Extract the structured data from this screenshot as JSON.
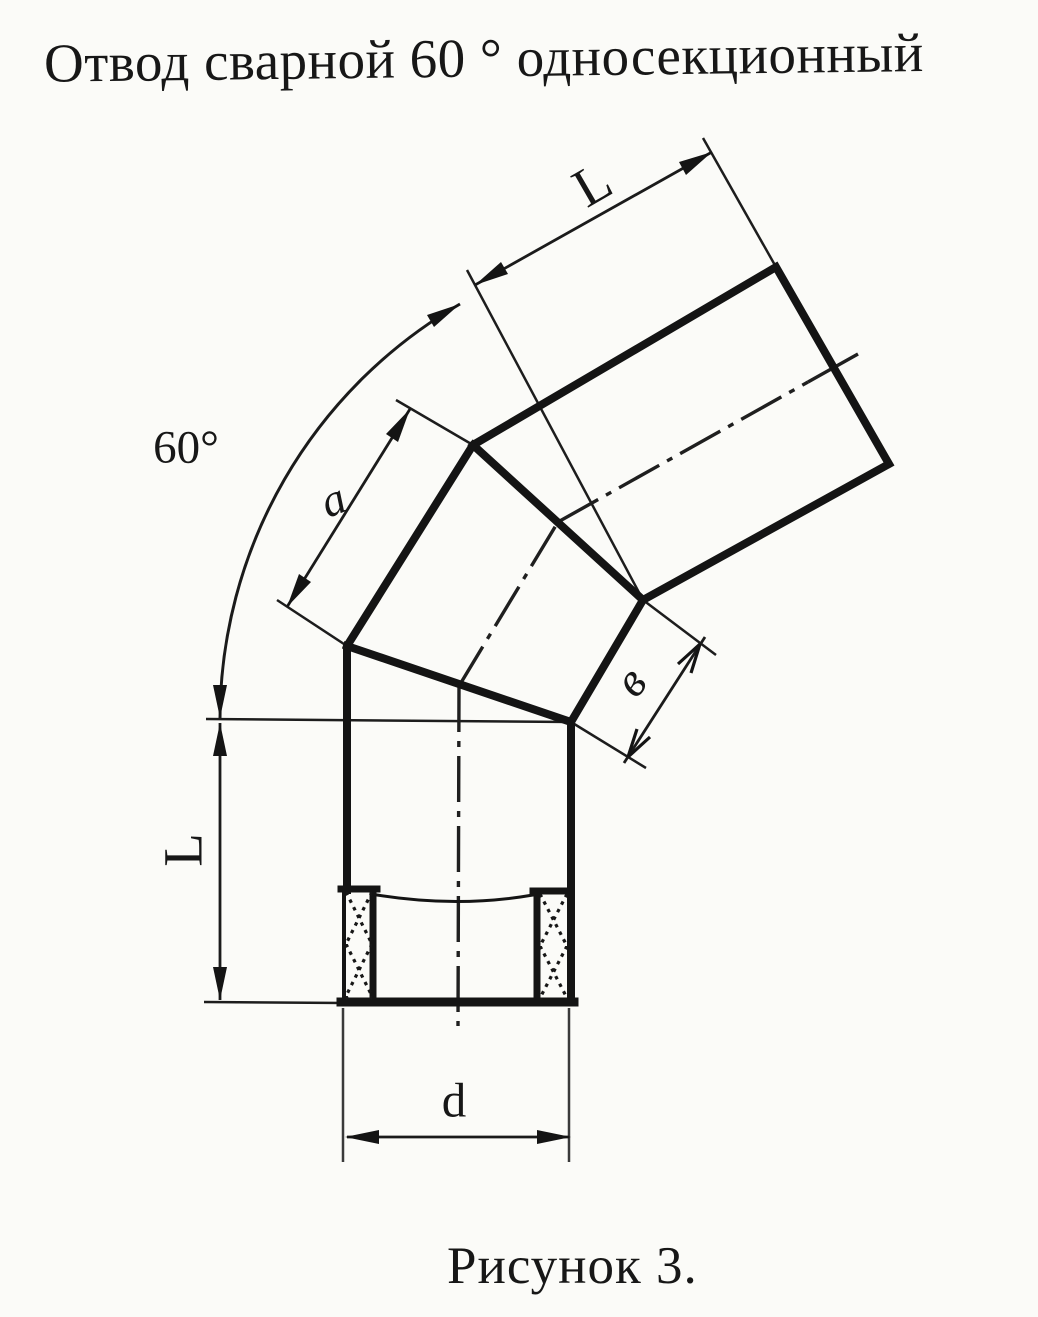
{
  "title": "Отвод сварной 60 ° односекционный",
  "caption": "Рисунок 3.",
  "labels": {
    "bend_angle": "60°",
    "top_run_length": "L",
    "vertical_run_length": "L",
    "outer_section_length": "a",
    "inner_section_length": "в",
    "pipe_diameter": "d"
  },
  "colors": {
    "paper": "#fbfbf8",
    "ink": "#171717"
  }
}
